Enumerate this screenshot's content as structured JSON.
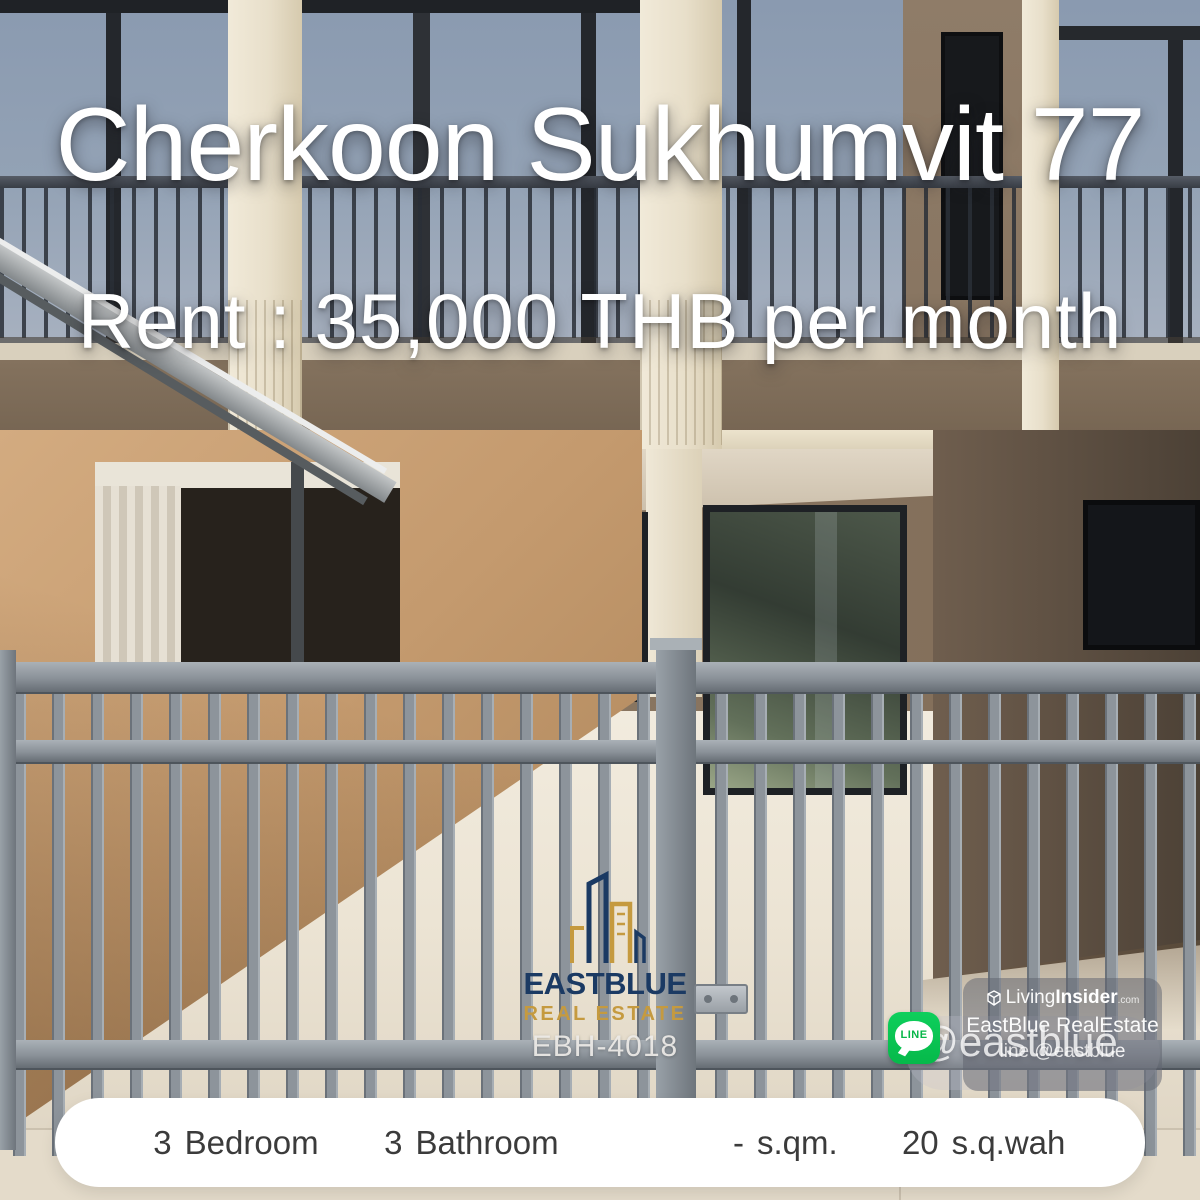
{
  "poster": {
    "title": "Cherkoon Sukhumvit 77",
    "rent": "Rent : 35,000 THB per month",
    "ref_code": "EBH-4018"
  },
  "agency_logo": {
    "name": "EASTBLUE",
    "tagline": "REAL ESTATE",
    "icon": "buildings-skyline-icon",
    "navy": "#1b3a63",
    "gold": "#c59a3f"
  },
  "contact": {
    "line_icon_label": "LINE",
    "line_handle_large": "@eastblue",
    "line_green": "#06c755"
  },
  "watermark": {
    "brand_light": "Living",
    "brand_bold": "Insider",
    "brand_suffix": ".com",
    "cube_icon": "livinginsider-cube-icon",
    "agency": "EastBlue RealEstate",
    "line_text": "line @eastblue"
  },
  "specs": {
    "items": [
      {
        "value": "3",
        "label": "Bedroom"
      },
      {
        "value": "3",
        "label": "Bathroom"
      },
      {
        "value": "-",
        "label": "s.qm."
      },
      {
        "value": "20",
        "label": "s.q.wah"
      }
    ]
  }
}
